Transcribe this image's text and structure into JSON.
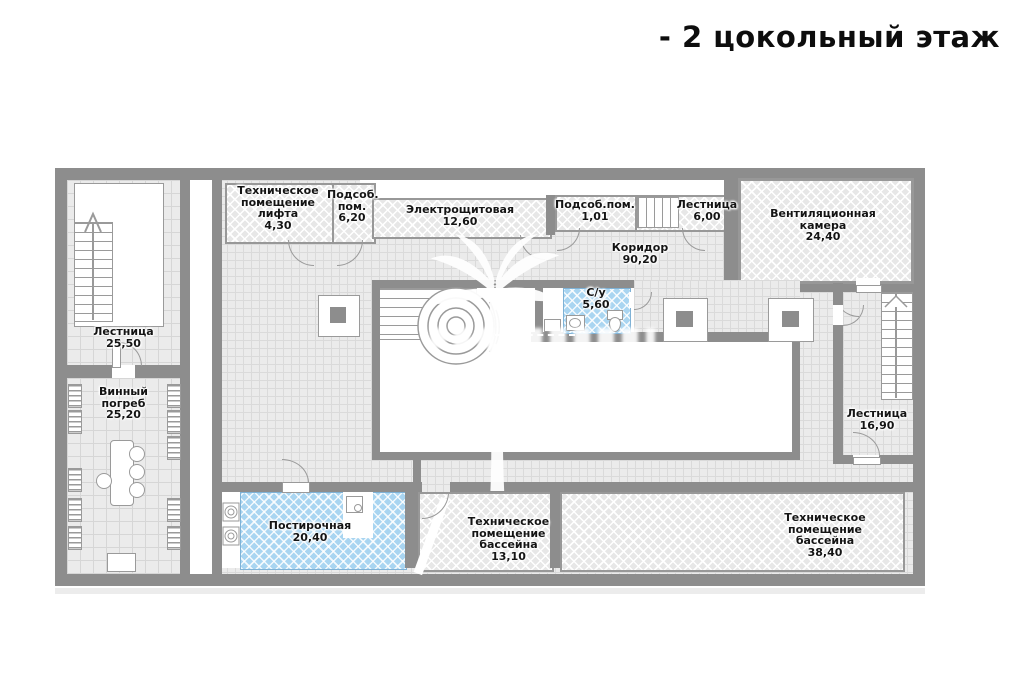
{
  "title": "- 2 цокольный этаж",
  "floor_plan": {
    "rooms": [
      {
        "name": "Лестница",
        "area": "25,50",
        "label": "Лестница\n25,50"
      },
      {
        "name": "Техническое помещение лифта",
        "area": "4,30",
        "label": "Техническое\nпомещение\nлифта\n4,30"
      },
      {
        "name": "Подсоб. пом.",
        "area": "6,20",
        "label": "Подсоб.\nпом.\n6,20"
      },
      {
        "name": "Электрощитовая",
        "area": "12,60",
        "label": "Электрощитовая\n12,60"
      },
      {
        "name": "Подсоб.пом.",
        "area": "1,01",
        "label": "Подсоб.пом.\n1,01"
      },
      {
        "name": "Лестница",
        "area": "6,00",
        "label": "Лестница\n6,00"
      },
      {
        "name": "Вентиляционная камера",
        "area": "24,40",
        "label": "Вентиляционная\nкамера\n24,40"
      },
      {
        "name": "Коридор",
        "area": "90,20",
        "label": "Коридор\n90,20"
      },
      {
        "name": "С/у",
        "area": "5,60",
        "label": "С/у\n5,60"
      },
      {
        "name": "Лестница",
        "area": "16,90",
        "label": "Лестница\n16,90"
      },
      {
        "name": "Винный погреб",
        "area": "25,20",
        "label": "Винный\nпогреб\n25,20"
      },
      {
        "name": "Постирочная",
        "area": "20,40",
        "label": "Постирочная\n20,40"
      },
      {
        "name": "Техническое помещение бассейна",
        "area": "13,10",
        "label": "Техническое\nпомещение\nбассейна\n13,10"
      },
      {
        "name": "Техническое помещение бассейна",
        "area": "38,40",
        "label": "Техническое\nпомещение\nбассейна\n38,40"
      }
    ],
    "colors": {
      "wall": "#8d8d8d",
      "floor_tile": "#ebebeb",
      "wet_room": "#a9d5f1",
      "hatch_room": "#e7e7e7",
      "text": "#141414"
    }
  }
}
